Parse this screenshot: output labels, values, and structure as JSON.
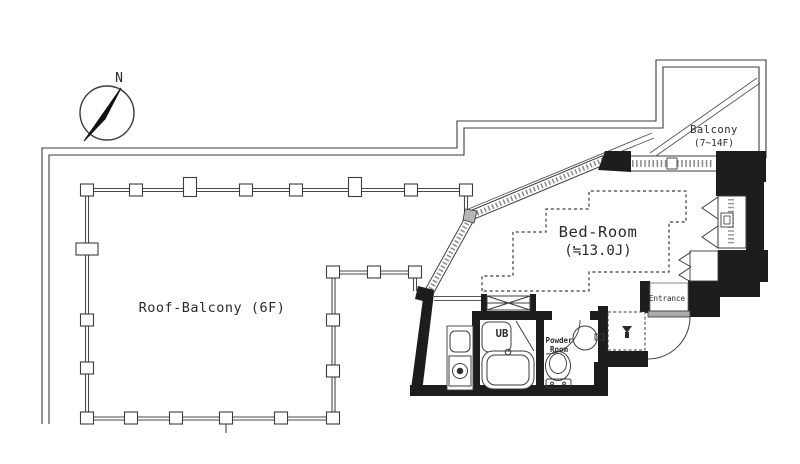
{
  "plan": {
    "compass": {
      "north": "N"
    },
    "roof_balcony": {
      "label": "Roof-Balcony (6F)"
    },
    "bed_room": {
      "name": "Bed-Room",
      "area": "(≒13.0J)"
    },
    "balcony": {
      "name": "Balcony",
      "floors": "(7~14F)"
    },
    "unit_bath": {
      "label": "UB"
    },
    "powder_room": {
      "line1": "Powder",
      "line2": "Room"
    },
    "entrance": {
      "label": "Entrance"
    }
  },
  "colors": {
    "background": "#ffffff",
    "line": "#3c3c3c",
    "wall": "#1d1d1d",
    "hatch": "#8a8a8a",
    "sill": "#ababab",
    "text": "#2a2a2a"
  }
}
